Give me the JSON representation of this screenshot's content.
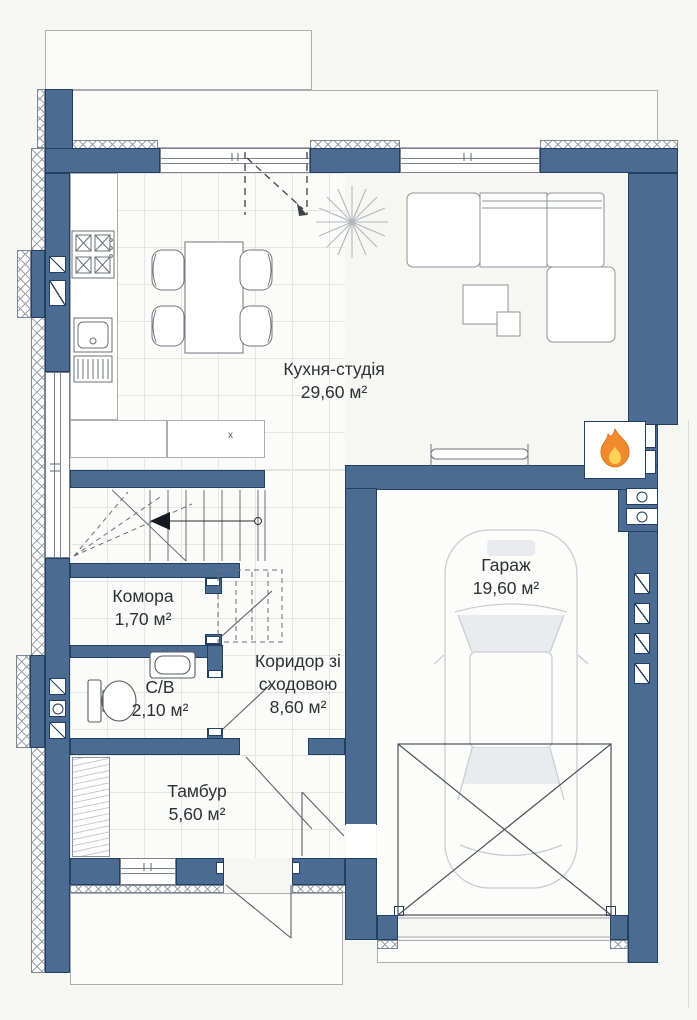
{
  "floor_plan": {
    "rooms": [
      {
        "id": "kitchen_studio",
        "label": "Кухня-студія",
        "area": "29,60 м²"
      },
      {
        "id": "garage",
        "label": "Гараж",
        "area": "19,60 м²"
      },
      {
        "id": "pantry",
        "label": "Комора",
        "area": "1,70 м²"
      },
      {
        "id": "bathroom",
        "label": "С/В",
        "area": "2,10 м²"
      },
      {
        "id": "corridor",
        "label": "Коридор зі сходовою",
        "area": "8,60 м²"
      },
      {
        "id": "vestibule",
        "label": "Тамбур",
        "area": "5,60 м²"
      }
    ],
    "marks": {
      "cabinet_mark": "x"
    },
    "icons": {
      "fireplace": "flame-icon",
      "plant": "plant-icon",
      "car": "car-top-view-icon",
      "stair_direction": "arrow-left-icon"
    },
    "colors": {
      "wall": "#4b6b93",
      "wall_outline": "#22405f",
      "flame_orange": "#f1892d",
      "flame_yellow": "#ffd255"
    }
  }
}
